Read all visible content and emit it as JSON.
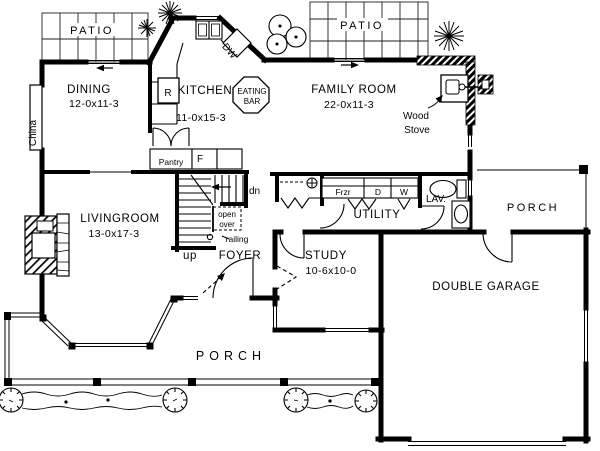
{
  "colors": {
    "ink": "#000000",
    "paper": "#ffffff"
  },
  "labels": {
    "patio_left": "PATIO",
    "patio_right": "PATIO",
    "dining_name": "DINING",
    "dining_dims": "12-0x11-3",
    "china": "China",
    "kitchen_name": "KITCHEN",
    "kitchen_dims": "11-0x15-3",
    "range": "R",
    "dishwasher": "DW",
    "eating_line1": "EATING",
    "eating_line2": "BAR",
    "family_name": "FAMILY ROOM",
    "family_dims": "22-0x11-3",
    "wood": "Wood",
    "stove": "Stove",
    "pantry": "Pantry",
    "fridge": "F",
    "living_name": "LIVINGROOM",
    "living_dims": "13-0x17-3",
    "up": "up",
    "dn": "dn",
    "open1": "open",
    "open2": "over",
    "railing": "railing",
    "foyer": "FOYER",
    "frzr": "Frzr",
    "dryer": "D",
    "washer": "W",
    "utility": "UTILITY",
    "lav": "LAV.",
    "porch_right": "PORCH",
    "study_name": "STUDY",
    "study_dims": "10-6x10-0",
    "garage": "DOUBLE GARAGE",
    "porch_bottom": "PORCH"
  }
}
